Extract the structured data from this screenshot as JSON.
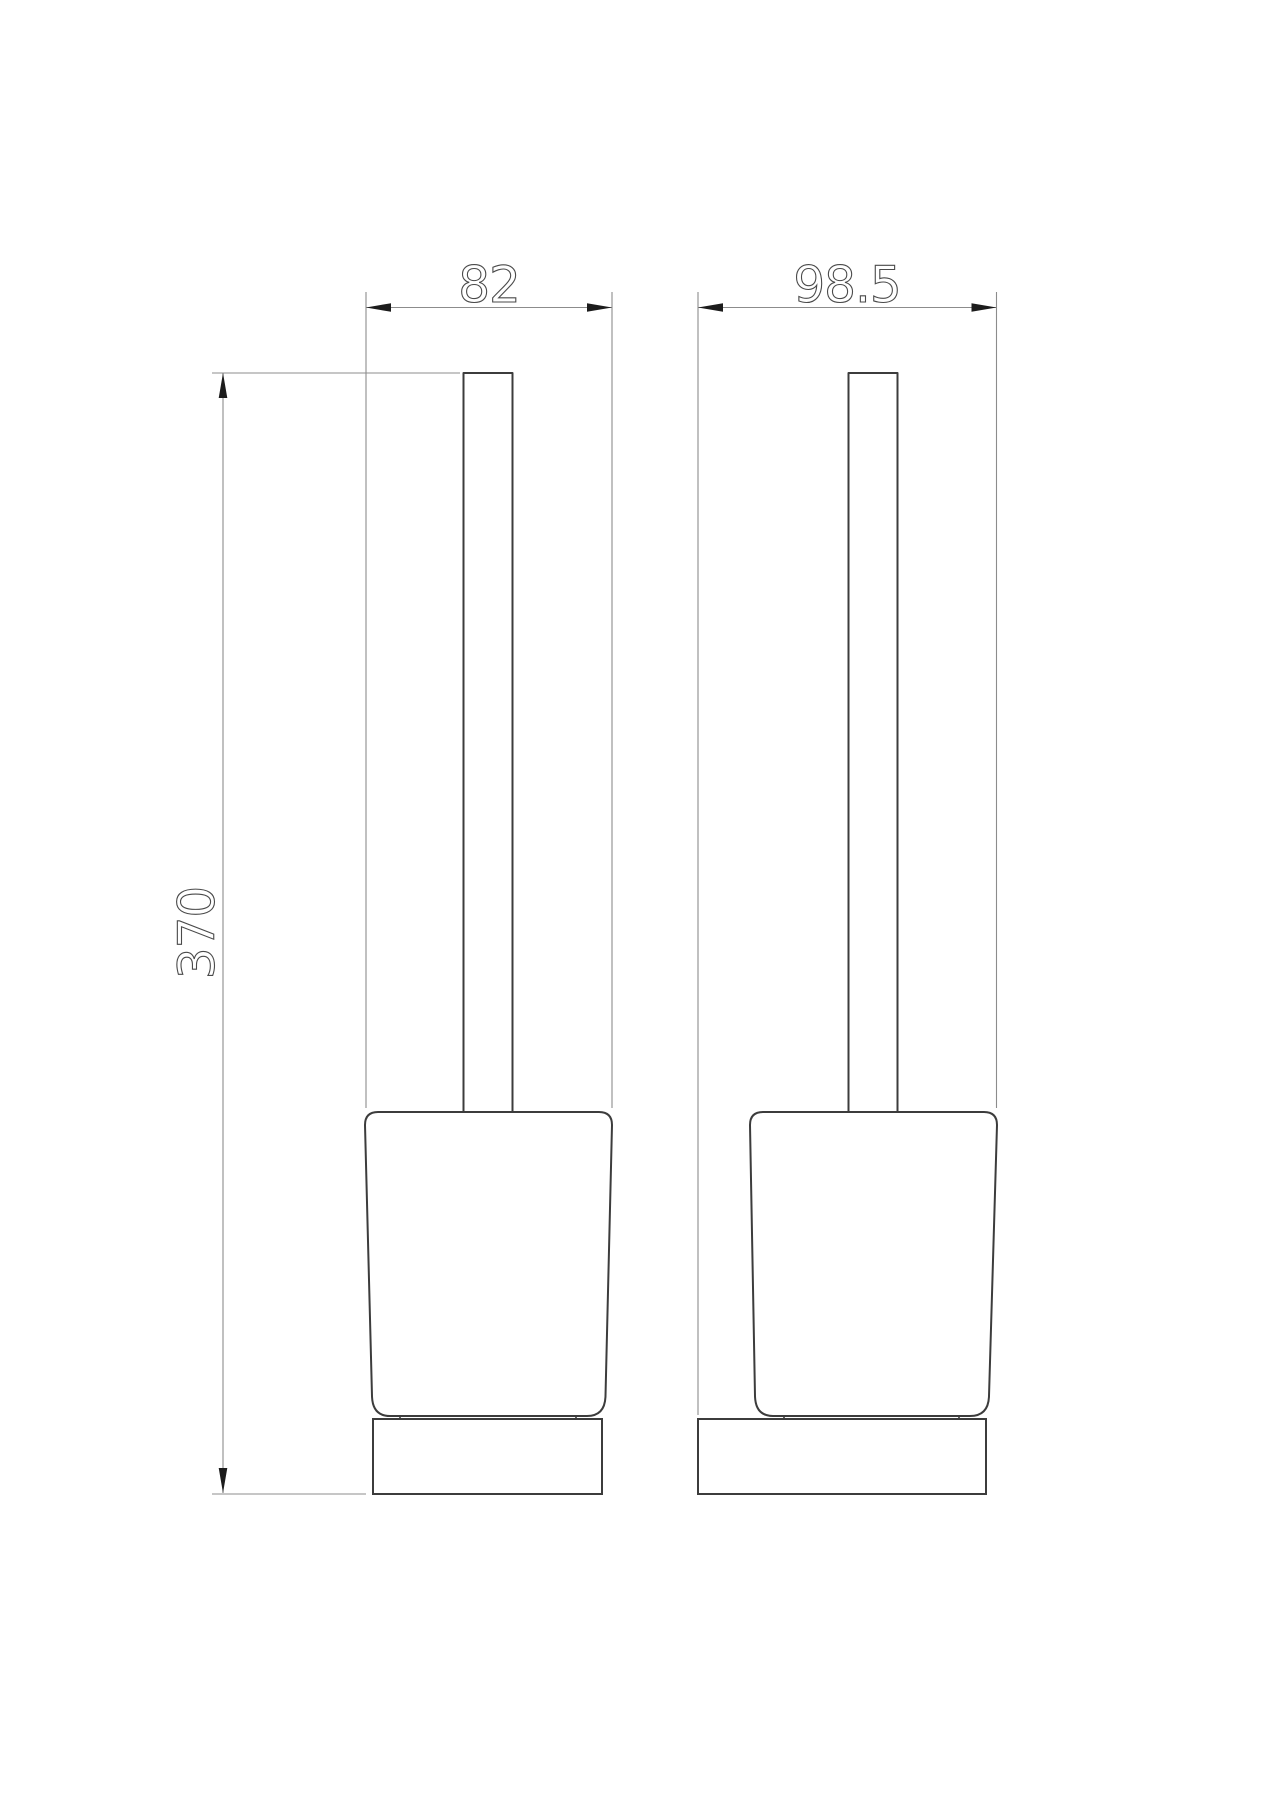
{
  "canvas": {
    "background": "#ffffff",
    "width_px": 1273,
    "height_px": 1800
  },
  "colors": {
    "object_line": "#3c3c3c",
    "dimension_line": "#8c8c8c",
    "arrowhead": "#1c1c1c",
    "dimension_text": "#4a4a4a"
  },
  "dims": {
    "width": {
      "label": "82",
      "orientation": "horizontal"
    },
    "depth": {
      "label": "98.5",
      "orientation": "horizontal"
    },
    "height": {
      "label": "370",
      "orientation": "vertical"
    }
  }
}
